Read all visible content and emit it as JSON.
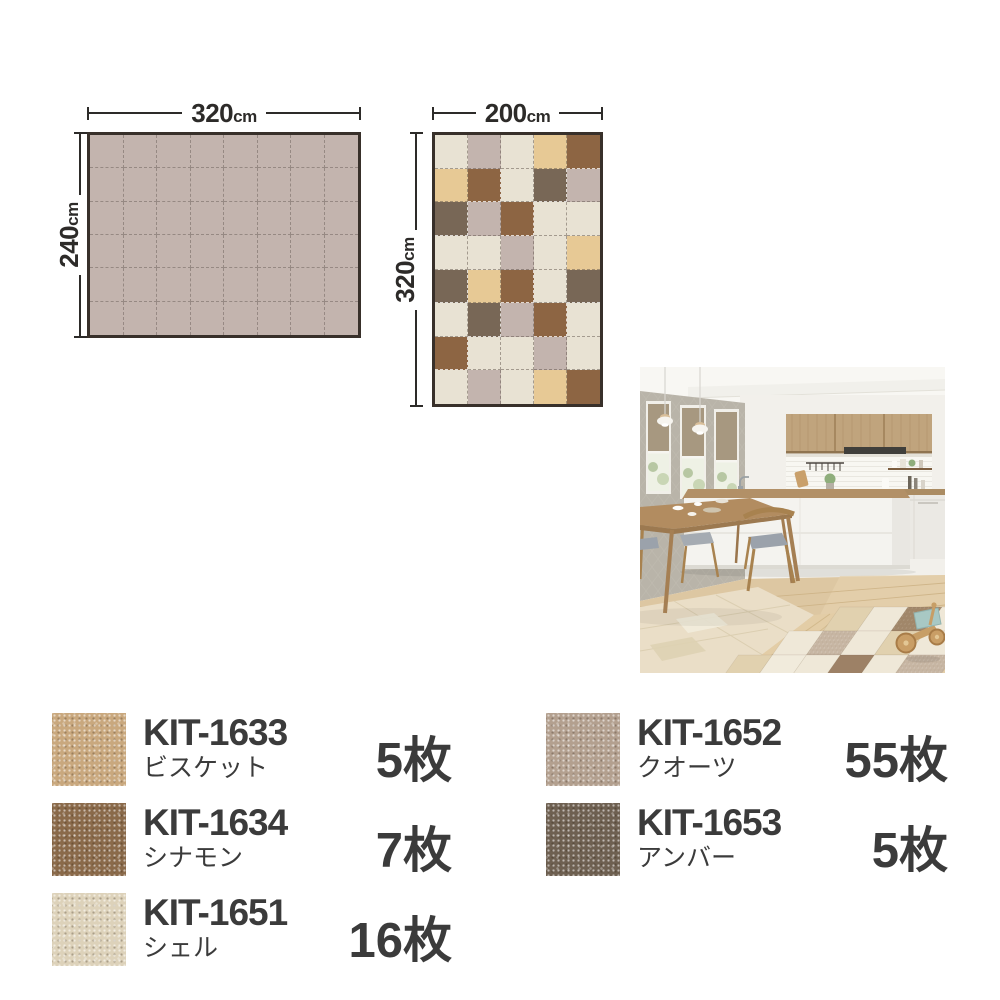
{
  "palette": {
    "shell": "#e8e2d3",
    "quartz": "#c3b4ae",
    "biscuit": "#e7c995",
    "cinnamon": "#8d6543",
    "amber": "#786756"
  },
  "dark_tiles": [
    "cinnamon",
    "amber"
  ],
  "swatch_colors": {
    "biscuit": "#c9a87e",
    "cinnamon": "#8a6a4a",
    "shell": "#ddd2ba",
    "quartz": "#b3a08f",
    "amber": "#6e6051"
  },
  "diagrams": {
    "plain_rug": {
      "width_value": "320",
      "width_unit": "cm",
      "height_value": "240",
      "height_unit": "cm",
      "cols": 8,
      "rows": 6,
      "tile": "quartz"
    },
    "checkered_rug": {
      "width_value": "200",
      "width_unit": "cm",
      "height_value": "320",
      "height_unit": "cm",
      "cols": 5,
      "rows": 8,
      "tile_map": [
        [
          "shell",
          "quartz",
          "shell",
          "biscuit",
          "cinnamon"
        ],
        [
          "biscuit",
          "cinnamon",
          "shell",
          "amber",
          "quartz"
        ],
        [
          "amber",
          "quartz",
          "cinnamon",
          "shell",
          "shell"
        ],
        [
          "shell",
          "shell",
          "quartz",
          "shell",
          "biscuit"
        ],
        [
          "amber",
          "biscuit",
          "cinnamon",
          "shell",
          "amber"
        ],
        [
          "shell",
          "amber",
          "quartz",
          "cinnamon",
          "shell"
        ],
        [
          "cinnamon",
          "shell",
          "shell",
          "quartz",
          "shell"
        ],
        [
          "shell",
          "quartz",
          "shell",
          "biscuit",
          "cinnamon"
        ]
      ]
    }
  },
  "legend": {
    "columns": [
      [
        {
          "code": "KIT-1633",
          "name": "ビスケット",
          "count": "5枚",
          "color": "biscuit"
        },
        {
          "code": "KIT-1634",
          "name": "シナモン",
          "count": "7枚",
          "color": "cinnamon"
        },
        {
          "code": "KIT-1651",
          "name": "シェル",
          "count": "16枚",
          "color": "shell"
        }
      ],
      [
        {
          "code": "KIT-1652",
          "name": "クオーツ",
          "count": "55枚",
          "color": "quartz"
        },
        {
          "code": "KIT-1653",
          "name": "アンバー",
          "count": "5枚",
          "color": "amber"
        }
      ]
    ]
  }
}
